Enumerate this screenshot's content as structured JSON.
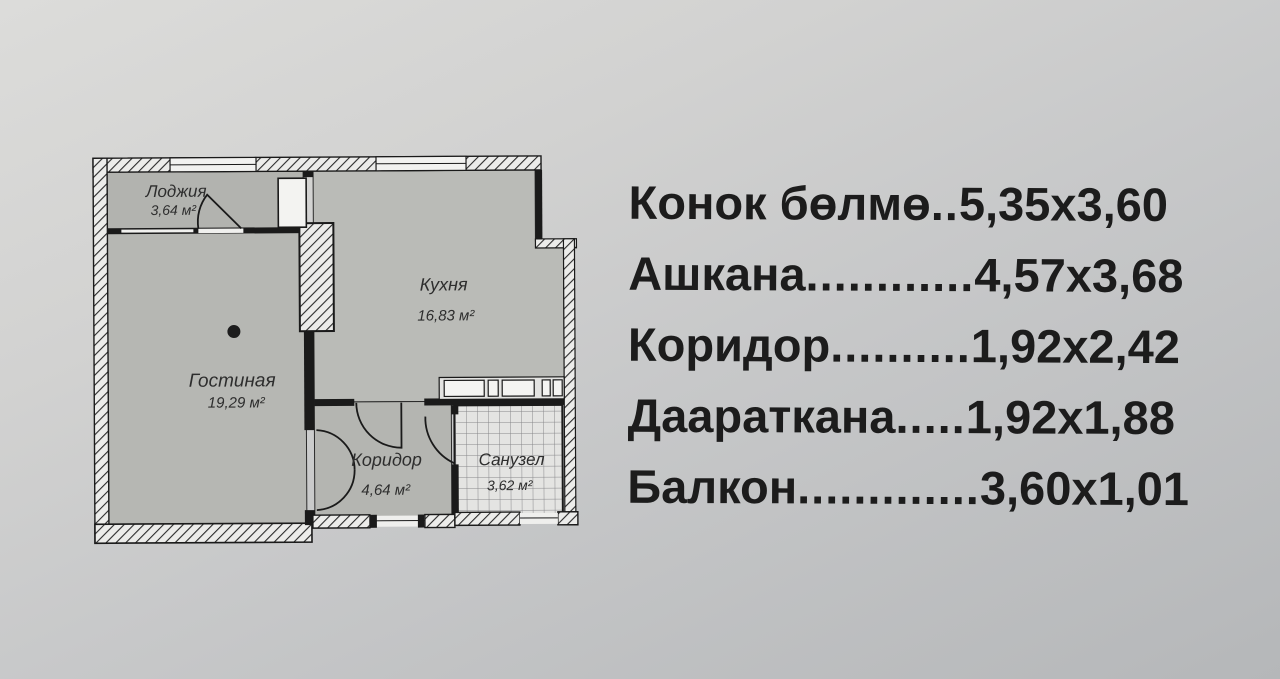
{
  "floor_plan": {
    "rooms": {
      "loggia": {
        "name": "Лоджия",
        "area": "3,64 м²"
      },
      "living_room": {
        "name": "Гостиная",
        "area": "19,29 м²"
      },
      "kitchen": {
        "name": "Кухня",
        "area": "16,83 м²"
      },
      "corridor": {
        "name": "Коридор",
        "area": "4,64 м²"
      },
      "bathroom": {
        "name": "Санузел",
        "area": "3,62 м²"
      }
    }
  },
  "dimensions_list": {
    "rows": [
      {
        "name": "Конок бөлмө",
        "dots": "..",
        "size": "5,35x3,60"
      },
      {
        "name": "Ашкана",
        "dots": "............",
        "size": "4,57x3,68"
      },
      {
        "name": "Коридор",
        "dots": "..........",
        "size": "1,92x2,42"
      },
      {
        "name": "Даараткана",
        "dots": ".....",
        "size": "1,92x1,88"
      },
      {
        "name": "Балкон",
        "dots": ".............",
        "size": "3,60x1,01"
      }
    ]
  },
  "colors": {
    "ink": "#1c1c1c",
    "room_fill": "#b6b7b3",
    "wall_hatch_bg": "#ececea",
    "paper_light": "#dcdcda",
    "paper_dark": "#b5b7b9"
  }
}
